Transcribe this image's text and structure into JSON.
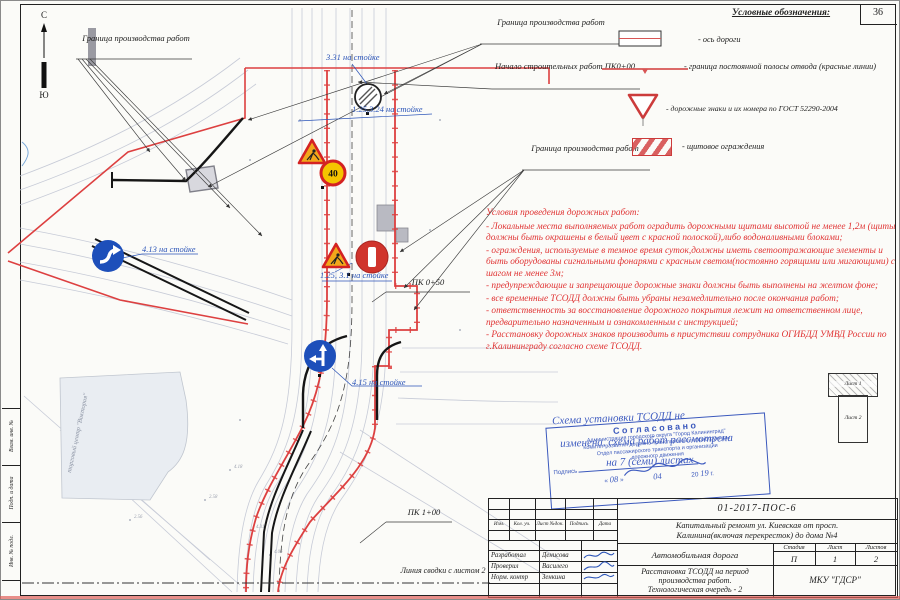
{
  "page": {
    "sheet_number": "36"
  },
  "compass": {
    "north": "С",
    "south": "Ю"
  },
  "labels": {
    "boundary": "Граница производства работ",
    "start_works": "Начало строительных работ ПК0+00",
    "pk050": "ПК 0+50",
    "pk100": "ПК 1+00",
    "match_line": "Линия сводки с листом 2",
    "building": "торговый центр \"Виктория\"",
    "sign_331": "3.31 на стойке",
    "sign_125_324": "1.25,3.24 на стойке",
    "sign_125_31": "1.25, 3.1 на стойке",
    "sign_413": "4.13 на стойке",
    "sign_415": "4.15 на стойке"
  },
  "map": {
    "speed": "40",
    "elevation_marks": [
      "4.53",
      "2.58",
      "4.31",
      "2.56",
      "4.18",
      "4.06"
    ]
  },
  "legend": {
    "title": "Условные обозначения:",
    "items": [
      {
        "symbol": "road-axis",
        "label": "-  ось дороги"
      },
      {
        "symbol": "red-boundary-line",
        "label": "- граница постоянной полосы отвода (красные линии)"
      },
      {
        "symbol": "road-sign-triangle",
        "label": "- дорожные знаки и их номера по ГОСТ 52290-2004"
      },
      {
        "symbol": "shield-fence",
        "label": "- щитовое ограждения"
      }
    ]
  },
  "conditions": {
    "title": "Условия проведения дорожных работ:",
    "items": [
      "- Локальные места выполняемых работ оградить дорожными щитами высотой не менее 1,2м (щиты должны быть окрашены в белый цвет с красной полоской),либо водоналивными блоками;",
      "- ограждения, используемые в темное время суток,должны иметь светоотражающие элементы и быть оборудованы сигнальными фонарями с красным светом(постоянно горящими или мигающими) с шагом не менее 3м;",
      "- предупреждающие и запрещающие дорожные знаки должны быть выполнены на желтом фоне;",
      "- все временные ТСОДД должны быть убраны незамедлительно после окончания работ;",
      "- ответственность за восстановление дорожного покрытия лежит на ответственном лице, предварительно назначенным и ознакомленным с инструкцией;",
      "- Расстановку дорожных знаков производить в присутствии сотрудника ОГИБДД УМВД России по г.Калининграду согласно схеме ТСОДД."
    ]
  },
  "stamp": {
    "title": "Согласовано",
    "org1": "Администрация городского округа \"Город Калининград\"",
    "org2": "Комитет развития дорожно-транспортной инфраструктуры",
    "org3": "Отдел пассажирского транспорта и организации",
    "org4": "дорожного движения",
    "signature_label": "Подпись",
    "quote_open": "«",
    "quote_close": "»",
    "day": "08",
    "month": "04",
    "century": "20",
    "year": "19",
    "year_suffix": "г."
  },
  "handwriting": {
    "line1": "Схема установки ТСОДД не",
    "line2": "изменена, схема работ рассмотрена",
    "line3": "на 7 (семи) листах"
  },
  "sheet_index": {
    "sheet1": "Лист 1",
    "sheet2": "Лист 2"
  },
  "frame_columns": {
    "col1": "Взам. инв. №",
    "col2": "Подп. и дата",
    "col3": "Инв. № подл."
  },
  "title_block": {
    "doc_number": "01-2017-ПОС-6",
    "project_line1": "Капитальный ремонт ул. Киевская от просп.",
    "project_line2": "Калинина(включая перекресток) до дома №4",
    "object_name": "Автомобильная дорога",
    "sheet_title_line1": "Расстановка ТСОДД на период",
    "sheet_title_line2": "производства работ.",
    "sheet_title_line3": "Технологическая очередь - 2",
    "org": "МКУ \"ГДСР\"",
    "stage_label": "Стадия",
    "sheet_label": "Лист",
    "sheets_label": "Листов",
    "stage": "П",
    "sheet": "1",
    "sheets": "2",
    "header_cols": [
      "Изм.",
      "Кол. уч.",
      "Лист №док.",
      "Подпись",
      "Дата"
    ],
    "roles": [
      {
        "role": "Разработал",
        "name": "Денисова"
      },
      {
        "role": "Проверил",
        "name": "Василего"
      },
      {
        "role": "Норм. контр",
        "name": "Зенкина"
      }
    ]
  }
}
